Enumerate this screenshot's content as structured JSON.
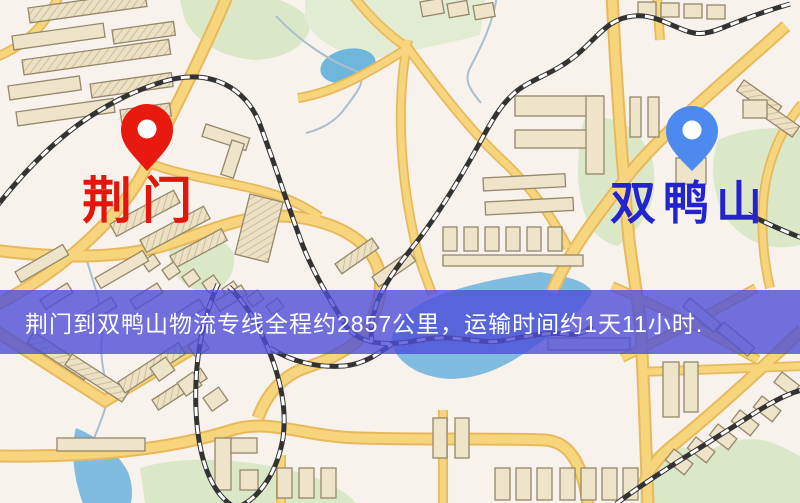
{
  "map": {
    "origin": {
      "label": "荆门",
      "marker_color": "#e8190e",
      "label_color": "#e4150b"
    },
    "destination": {
      "label": "双鸭山",
      "marker_color": "#4d8af0",
      "label_color": "#2424cf"
    },
    "palette": {
      "background": "#f8f2ec",
      "road": "#f7d57c",
      "road_casing": "#e8b95c",
      "water": "#7fbcdf",
      "park": "#dbe8c8",
      "building": "#eee4ca",
      "railway": "#333333",
      "banner_background": "rgba(78,78,216,0.8)",
      "banner_text": "#ffffff"
    }
  },
  "banner": {
    "text": "荆门到双鸭山物流专线全程约2857公里，运输时间约1天11小时."
  }
}
